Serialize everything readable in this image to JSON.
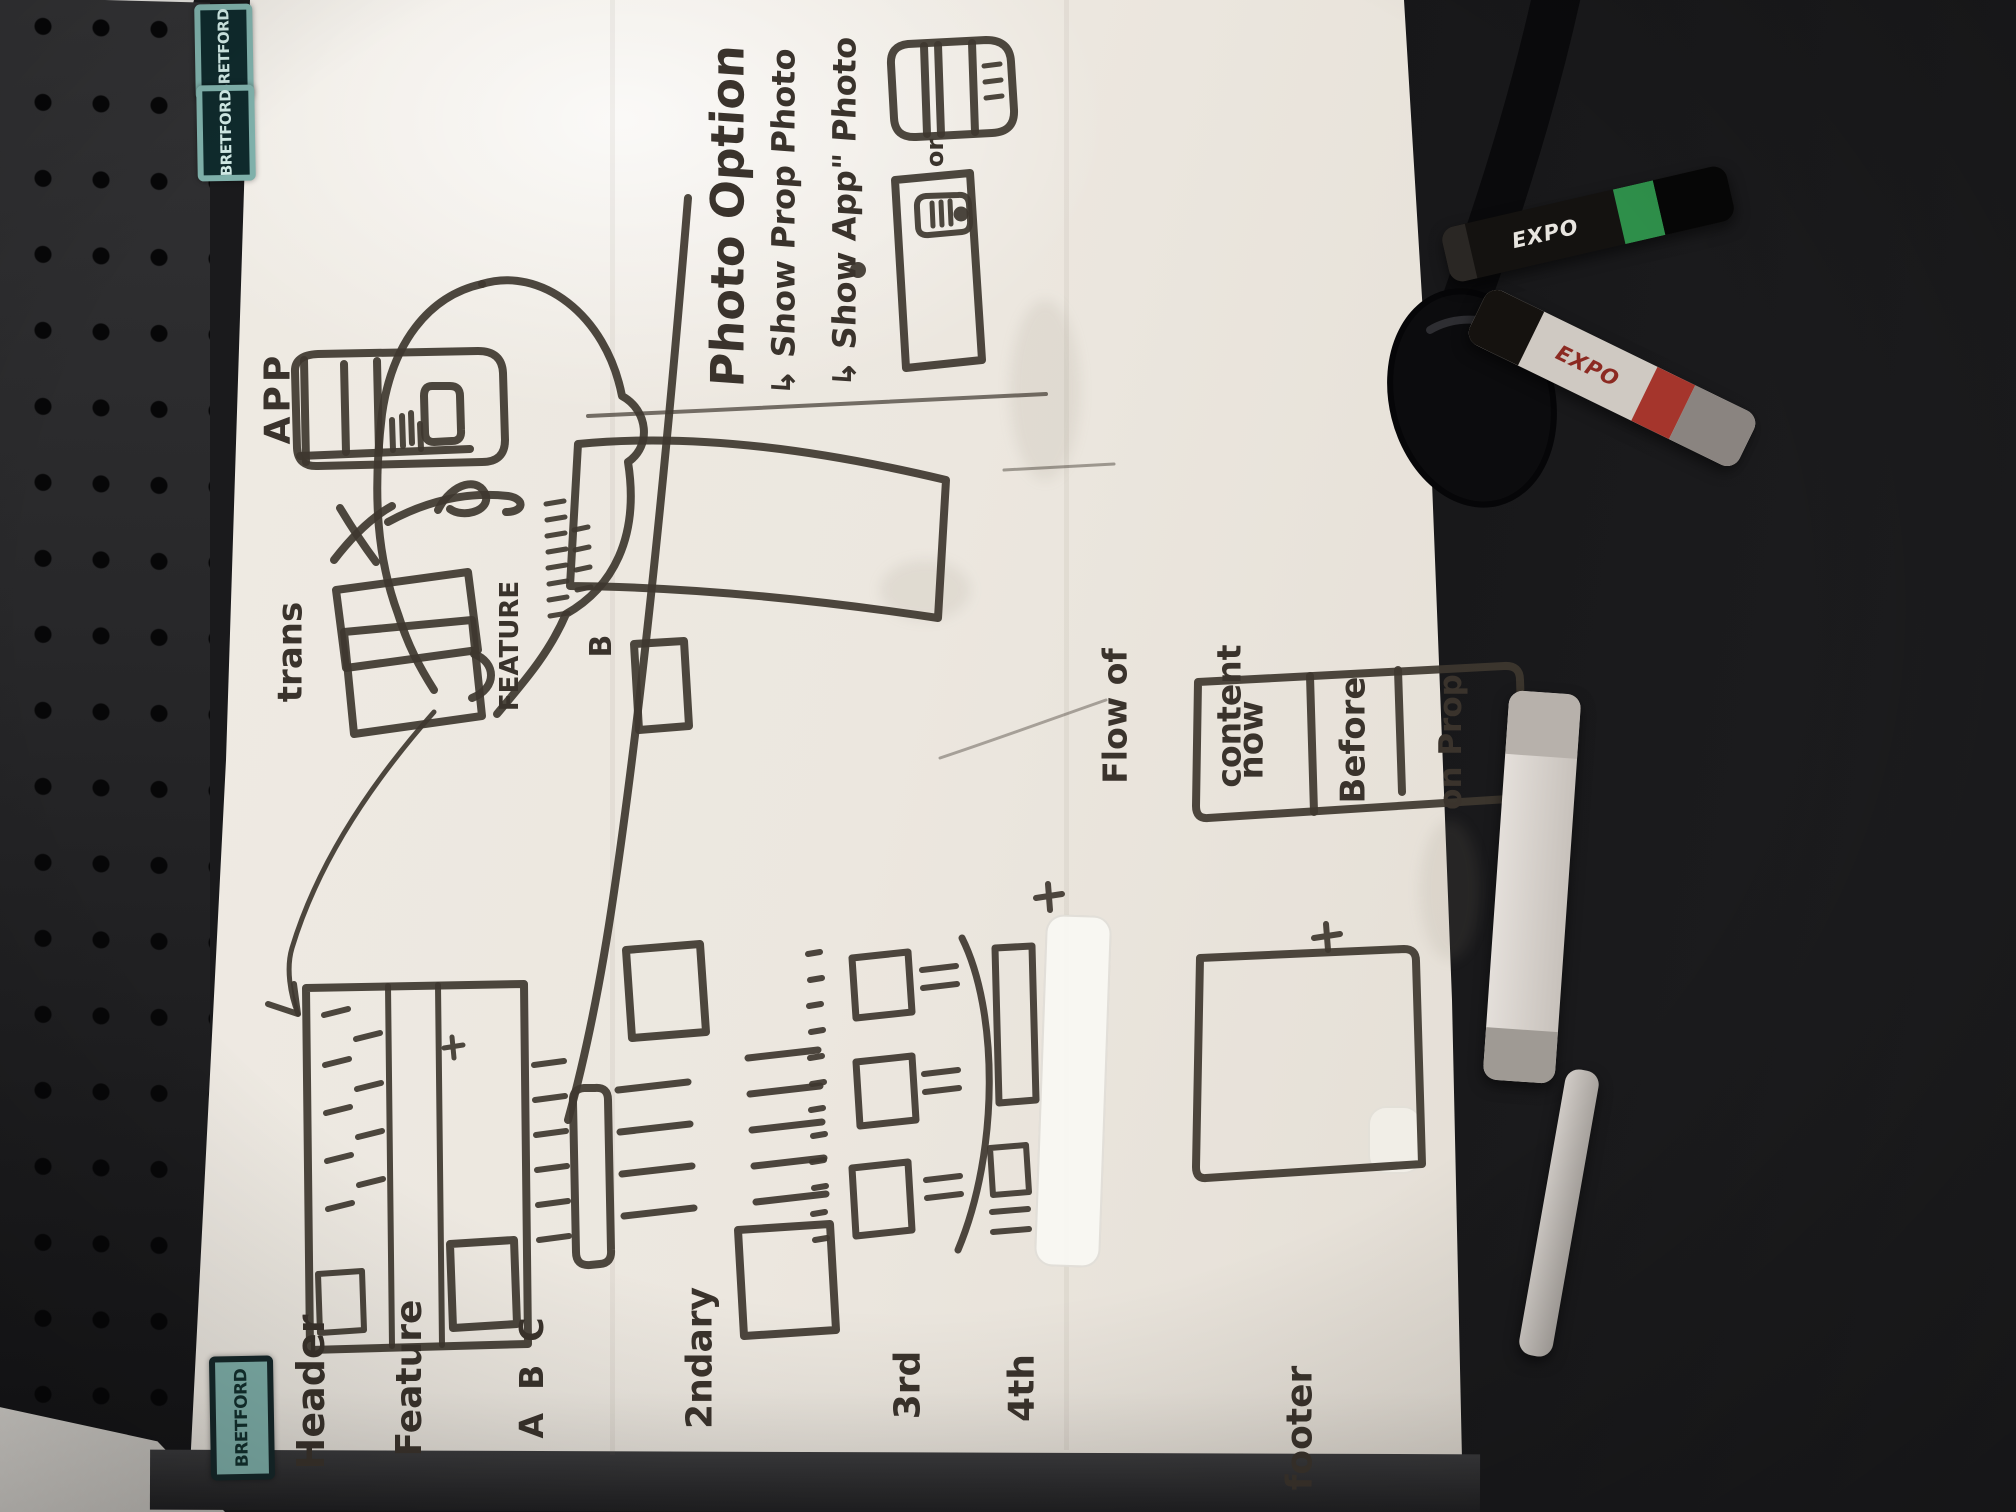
{
  "board": {
    "photo_option": {
      "title": "Photo Option",
      "note_prop": "↳ Show Prop Photo",
      "note_app": "↳ Show App\" Photo",
      "or_label": "or"
    },
    "app_note": {
      "label": "APP"
    },
    "trans_note": {
      "label": "trans"
    },
    "feature_b": {
      "label": "FEATURE",
      "variant": "B"
    },
    "flow": {
      "label_line1": "Flow of",
      "label_line2": "content",
      "cells": [
        "now",
        "Before",
        "on Prop"
      ]
    },
    "section_labels": {
      "header": "Header",
      "feature": "Feature",
      "feature_variants": "A  B  C",
      "secondary": "2ndary",
      "third": "3rd",
      "fourth": "4th",
      "footer": "footer"
    }
  },
  "frame": {
    "sticker_brand": "BRETFORD"
  },
  "markers": {
    "brand": "EXPO"
  },
  "colors": {
    "ink": "#3e372f",
    "board_white": "#ece7df",
    "sticker_teal": "#7fb0aa",
    "expo_green": "#2e8f4a",
    "expo_red": "#a5352c"
  }
}
